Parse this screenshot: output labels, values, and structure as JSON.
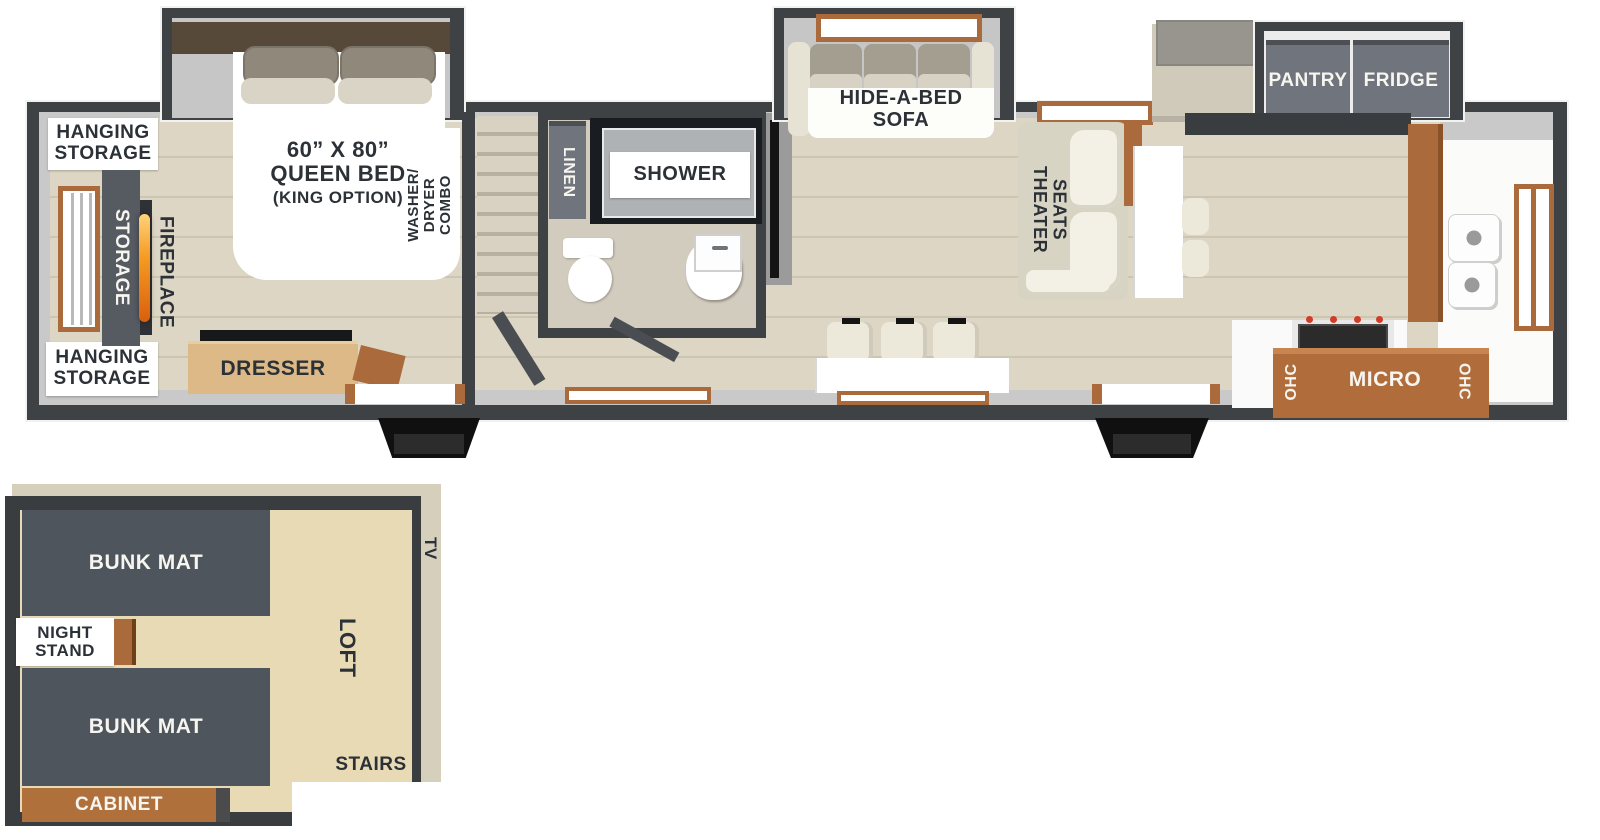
{
  "colors": {
    "exterior_wall": "#3e4245",
    "interior_wall": "#c9c9c9",
    "wood_floor": "#ddd6c5",
    "slide_floor": "#c6c6c6",
    "loft_floor": "#e8dab4",
    "accent_brown": "#aa6a3b",
    "cabinet_gray": "#70757d",
    "bunk_gray": "#4e555c",
    "label_text": "#2b3137",
    "flame_orange": "#f59b23"
  },
  "main": {
    "bedroom": {
      "hanging_storage_top": "HANGING\nSTORAGE",
      "hanging_storage_bottom": "HANGING\nSTORAGE",
      "storage": "STORAGE",
      "fireplace": "FIREPLACE",
      "bed_size": "60” X 80”",
      "bed_name": "QUEEN BED",
      "bed_option": "(KING OPTION)",
      "washer_dryer": "WASHER/\nDRYER\nCOMBO",
      "dresser": "DRESSER"
    },
    "bathroom": {
      "linen": "LINEN",
      "shower": "SHOWER"
    },
    "living": {
      "sofa": "HIDE-A-BED\nSOFA",
      "theater_seats": "THEATER\nSEATS"
    },
    "kitchen": {
      "pantry": "PANTRY",
      "fridge": "FRIDGE",
      "ohc_left": "OHC",
      "micro": "MICRO",
      "ohc_right": "OHC"
    }
  },
  "loft": {
    "bunk_mat_top": "BUNK MAT",
    "night_stand": "NIGHT\nSTAND",
    "bunk_mat_bottom": "BUNK MAT",
    "cabinet": "CABINET",
    "loft": "LOFT",
    "tv": "TV",
    "stairs": "STAIRS"
  }
}
